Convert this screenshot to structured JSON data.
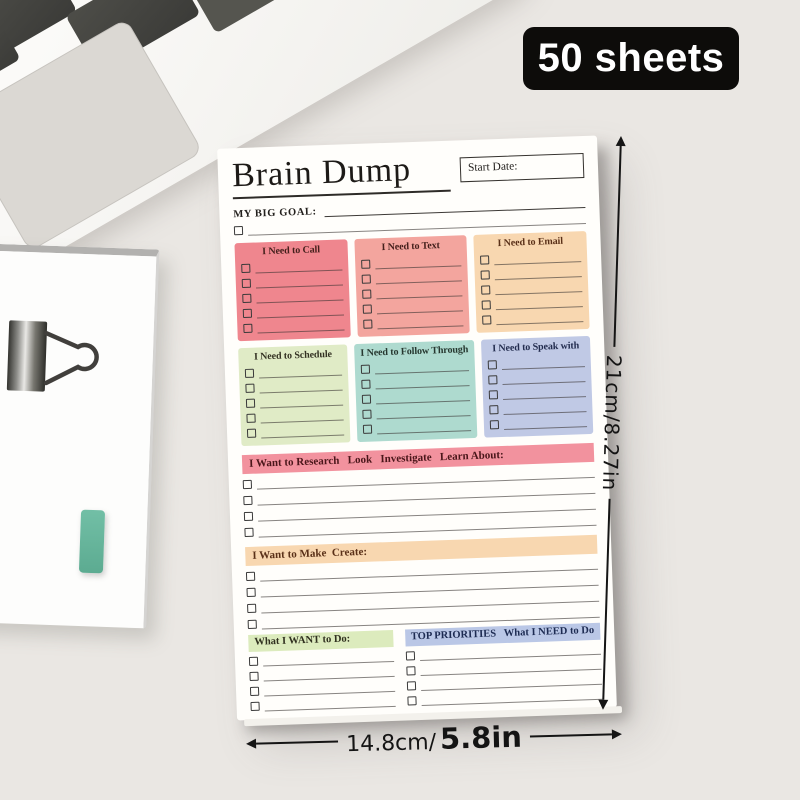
{
  "scene": {
    "background": "#eae7e3",
    "badge_label": "50 sheets",
    "height_label": "21cm/8.27in",
    "width_label_cm": "14.8cm/",
    "width_label_in": "5.8in"
  },
  "notepad": {
    "title": "Brain Dump",
    "start_date_label": "Start Date:",
    "big_goal_label": "MY BIG GOAL:",
    "boxes": [
      {
        "label": "I Need to Call",
        "bg": "#ef868e",
        "title_color": "#44201c",
        "lines": 5
      },
      {
        "label": "I Need to Text",
        "bg": "#f3a59e",
        "title_color": "#44201c",
        "lines": 5
      },
      {
        "label": "I Need to Email",
        "bg": "#f8d7b0",
        "title_color": "#5a3018",
        "lines": 5
      },
      {
        "label": "I Need to Schedule",
        "bg": "#e0ebc6",
        "title_color": "#333122",
        "lines": 5
      },
      {
        "label": "I Need to Follow Through",
        "bg": "#aedacf",
        "title_color": "#26372f",
        "lines": 5
      },
      {
        "label": "I Need to Speak with",
        "bg": "#c0c9e5",
        "title_color": "#232d4f",
        "lines": 5
      }
    ],
    "wide_sections": [
      {
        "label": "I Want to Research   Look   Investigate   Learn About:",
        "bg": "#f2929e",
        "text_color": "#4a161a",
        "lines": 4
      },
      {
        "label": "I Want to Make  Create:",
        "bg": "#f8d7b0",
        "text_color": "#5a3018",
        "lines": 4
      }
    ],
    "bottom_sections": [
      {
        "label": "What I WANT to Do:",
        "bg": "#dcebbd",
        "text_color": "#30301f",
        "lines": 4
      },
      {
        "label": "TOP PRIORITIES   What I NEED to Do",
        "bg": "#bac7e6",
        "text_color": "#1d2b52",
        "lines": 4
      }
    ]
  }
}
